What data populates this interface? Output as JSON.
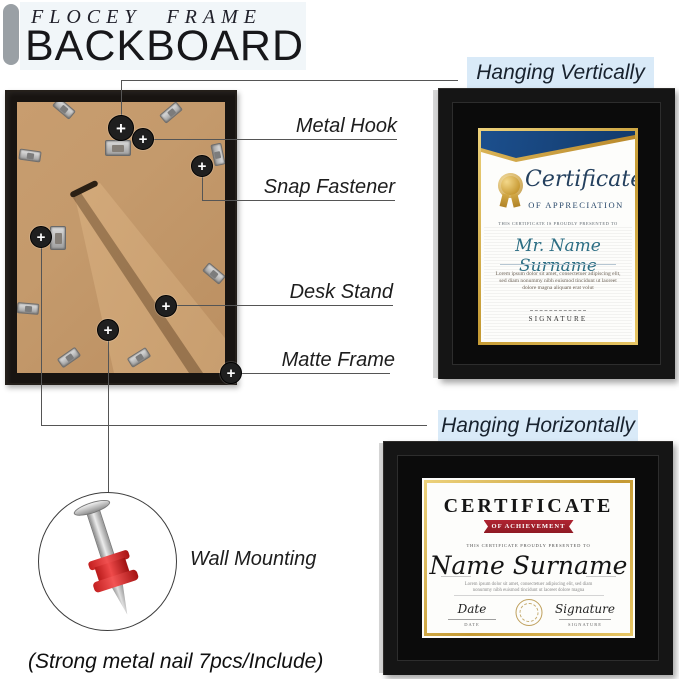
{
  "header": {
    "brand": "FLOCEY FRAME",
    "title": "BACKBOARD"
  },
  "callouts": {
    "hanging_vertically": "Hanging Vertically",
    "hanging_horizontally": "Hanging Horizontally",
    "metal_hook": "Metal Hook",
    "snap_fastener": "Snap Fastener",
    "desk_stand": "Desk Stand",
    "matte_frame": "Matte Frame",
    "wall_mounting": "Wall Mounting",
    "note": "(Strong metal nail 7pcs/Include)",
    "marker_plus": "+"
  },
  "vertical_certificate": {
    "title": "Certificate",
    "subtitle": "OF APPRECIATION",
    "presented": "THIS CERTIFICATE IS PROUDLY PRESENTED TO",
    "name": "Mr. Name Surname",
    "body": "Lorem ipsum dolor sit amet, consectetuer adipiscing elit, sed diam nonummy nibh euismod tincidunt ut laoreet dolore magna aliquam erat volut",
    "signature_caps": "SIGNATURE"
  },
  "horizontal_certificate": {
    "title": "CERTIFICATE",
    "banner": "OF ACHIEVEMENT",
    "presented": "THIS CERTIFICATE PROUDLY PRESENTED TO",
    "name": "Name Surname",
    "body": "Lorem ipsum dolor sit amet, consectetuer adipiscing elit, sed diam nonummy nibh euismod tincidunt ut laoreet dolore magna",
    "date_label": "Date",
    "date_caps": "DATE",
    "signature_label": "Signature",
    "signature_caps": "SIGNATURE"
  },
  "colors": {
    "label_blue_bg": "#d9eaf8",
    "kraft_board": "#c49a6c",
    "frame_black": "#151515",
    "banner_navy": "#1c4f8d",
    "gold": "#c59a33",
    "ribbon_red": "#b02432",
    "nail_red": "#d42b2b",
    "accent_gray_bar": "#9aa0a5"
  }
}
